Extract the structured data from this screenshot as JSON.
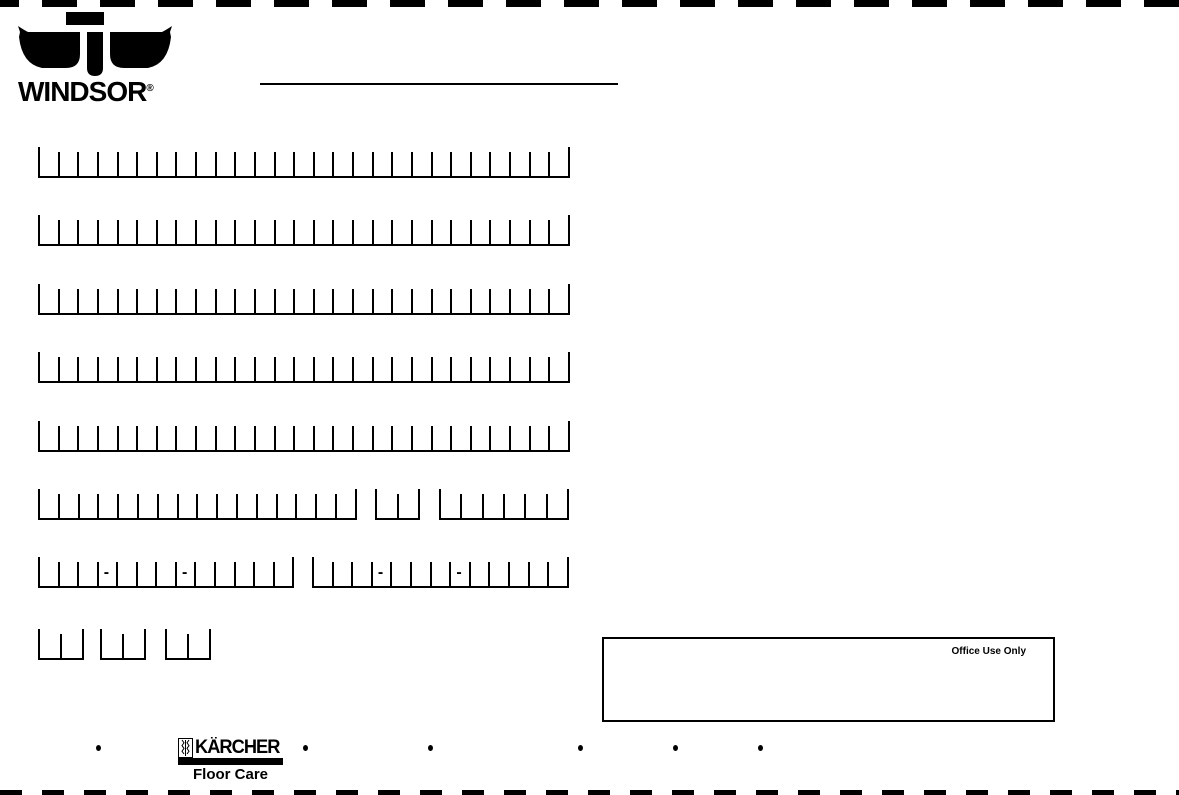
{
  "page": {
    "bg": "#ffffff",
    "ink": "#000000"
  },
  "header": {
    "brand": "WINDSOR",
    "registered_mark": "®"
  },
  "office_box": {
    "label": "Office Use Only"
  },
  "footer": {
    "bullet_glyph": "•",
    "bullet_x": [
      96,
      303,
      428,
      578,
      673,
      758
    ],
    "karcher": "KÄRCHER",
    "karcher_sub": "Floor Care"
  },
  "form": {
    "dash_glyph": "-",
    "rows": [
      {
        "y": 147,
        "groups": [
          {
            "x": 38,
            "cells": 27,
            "cell_w": 19.63
          }
        ]
      },
      {
        "y": 215,
        "groups": [
          {
            "x": 38,
            "cells": 27,
            "cell_w": 19.63
          }
        ]
      },
      {
        "y": 284,
        "groups": [
          {
            "x": 38,
            "cells": 27,
            "cell_w": 19.63
          }
        ]
      },
      {
        "y": 352,
        "groups": [
          {
            "x": 38,
            "cells": 27,
            "cell_w": 19.63
          }
        ]
      },
      {
        "y": 421,
        "groups": [
          {
            "x": 38,
            "cells": 27,
            "cell_w": 19.63
          }
        ]
      },
      {
        "y": 489,
        "groups": [
          {
            "x": 38,
            "cells": 16,
            "cell_w": 19.8
          },
          {
            "x": 375,
            "cells": 2,
            "cell_w": 21.5
          },
          {
            "x": 439,
            "cells": 6,
            "cell_w": 21.3
          }
        ]
      },
      {
        "y": 557,
        "groups": [
          {
            "x": 38,
            "cells": 13,
            "cell_w": 19.55,
            "dashes": [
              3,
              7
            ]
          },
          {
            "x": 312,
            "cells": 13,
            "cell_w": 19.6,
            "dashes": [
              3,
              7
            ]
          }
        ]
      },
      {
        "y": 629,
        "groups": [
          {
            "x": 38,
            "cells": 2,
            "cell_w": 22
          },
          {
            "x": 100,
            "cells": 2,
            "cell_w": 22
          },
          {
            "x": 165,
            "cells": 2,
            "cell_w": 22
          }
        ]
      }
    ]
  }
}
